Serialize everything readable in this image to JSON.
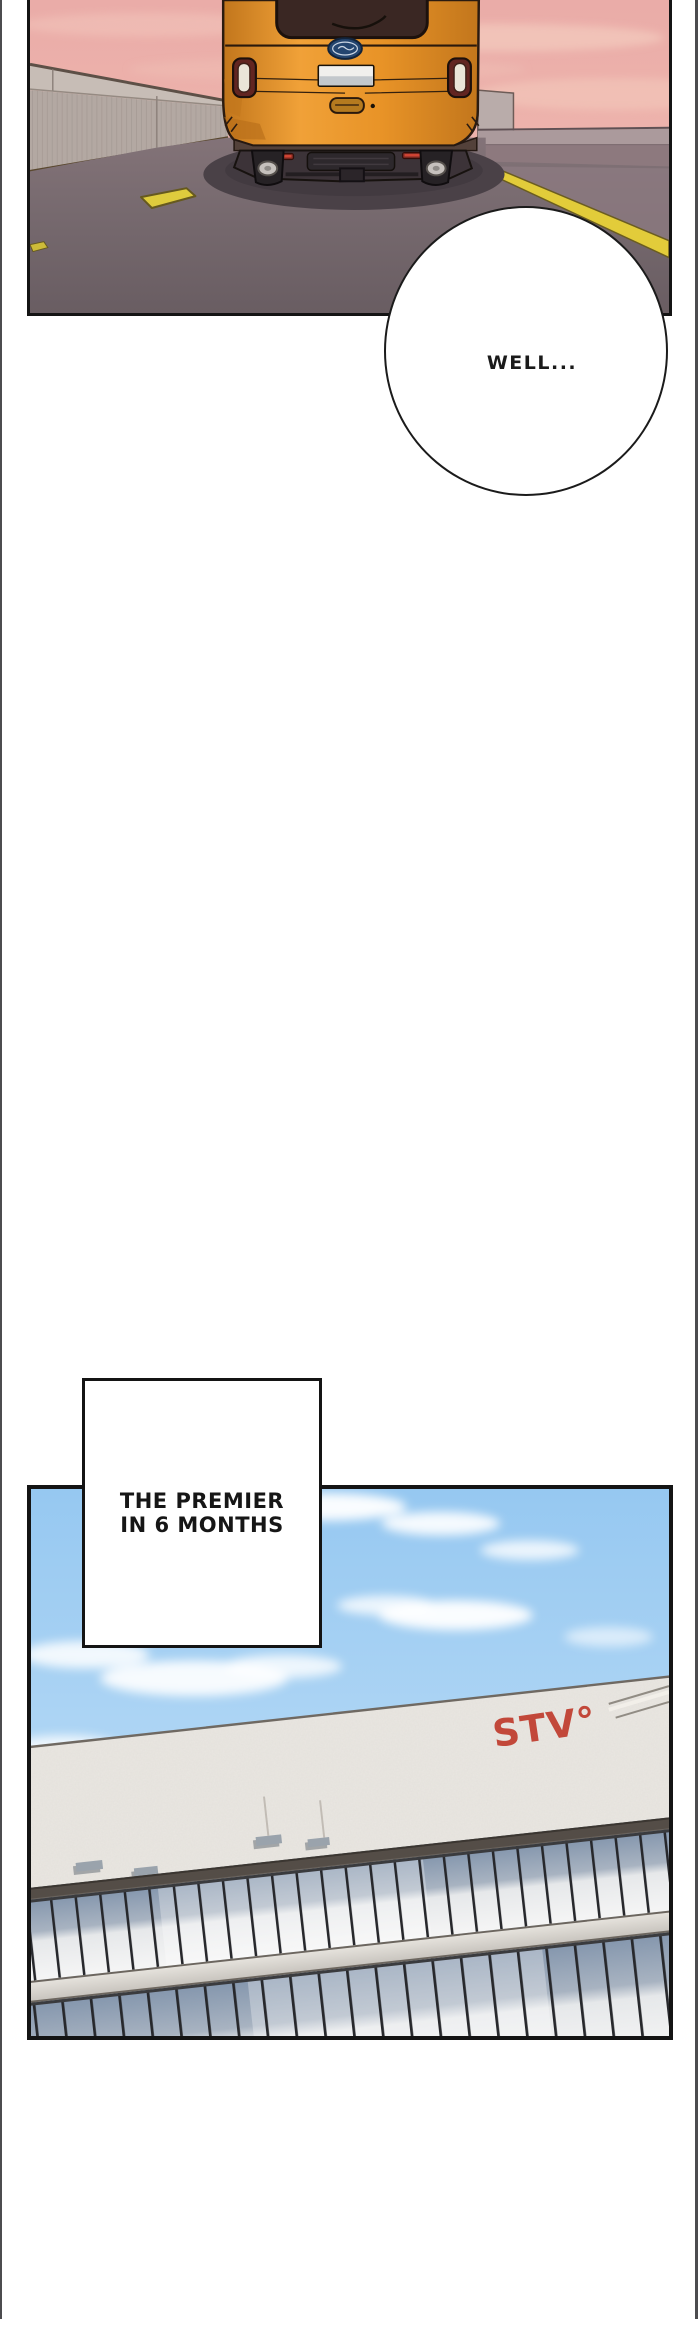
{
  "comic": {
    "bubble_text": "WELL...",
    "caption_line1": "THE PREMIER",
    "caption_line2": "IN 6 MONTHS",
    "building_sign": "STV°"
  },
  "colors": {
    "page_bg": "#ffffff",
    "page_edge_line": "#4c4c4f",
    "panel_border": "#141414",
    "sunset_sky_top": "#eaaca8",
    "sunset_sky_bottom": "#f2c2b6",
    "concrete_wall": "#b3a8a2",
    "road": "#7a6d72",
    "lane_line_yellow": "#e2cc3a",
    "car_orange": "#e89327",
    "car_window_brown": "#3a2723",
    "tail_light_maroon": "#622521",
    "day_sky_top": "#96c8f1",
    "day_sky_bottom": "#d3e7f9",
    "building_facade": "#eae7e2",
    "window_blue_gray": "#8496ad",
    "sign_red": "#c2483a"
  }
}
